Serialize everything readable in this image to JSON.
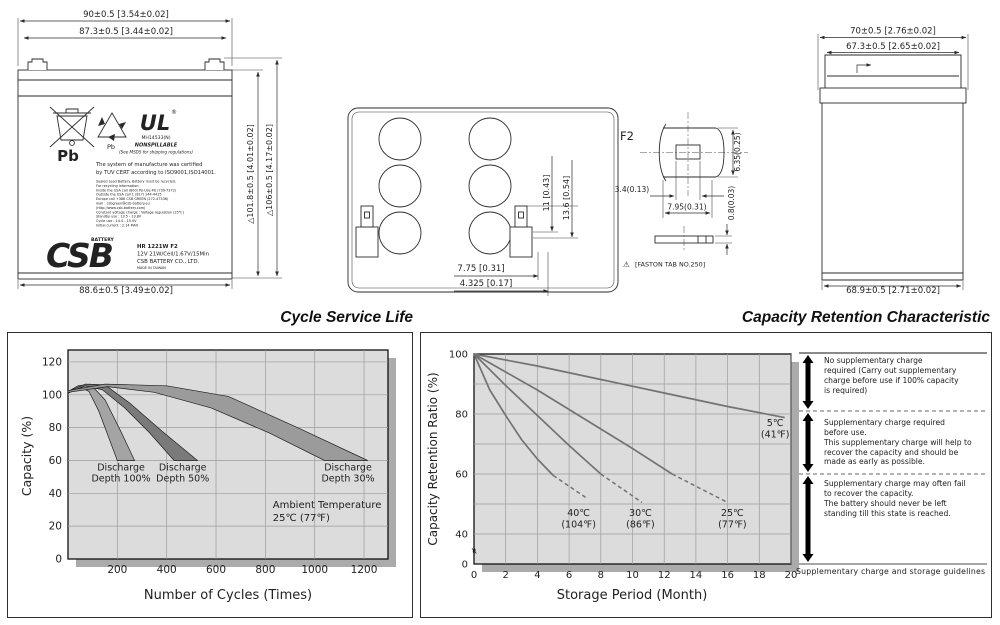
{
  "colors": {
    "plot_bg": "#dcdcdc",
    "plot_shadow": "#ababab",
    "grid": "#9c9c9c",
    "curve": "#737373",
    "band_100": "#a4a4a4",
    "band_50": "#7a7a7a",
    "band_30": "#9b9b9b"
  },
  "front_view": {
    "dims": {
      "top_outer": "90±0.5  [3.54±0.02]",
      "top_inner": "87.3±0.5  [3.44±0.02]",
      "bottom": "88.6±0.5  [3.49±0.02]",
      "height_case": "△101.8±0.5  [4.01±0.02]",
      "height_total": "△106±0.5  [4.17±0.02]"
    },
    "label": {
      "pb_large": "Pb",
      "pb_small": "Pb",
      "ul_mark": "UL",
      "ul_reg": "®",
      "ul_file": "MH14533(N)",
      "nonspillable": "NONSPILLABLE",
      "msds_note": "(See MSDS for shipping regulations)",
      "cert_line1": "The system of manufacture was certified",
      "cert_line2": "by TUV CERT according to ISO9001,ISO14001.",
      "small_print": [
        "Sealed Lead Battery. Battery must be recycled.",
        "For recycling information:",
        "Inside   the USA call (800) Po-Use-Pb (739-7372)",
        "Outside the USA call 1 (817) 244-4415",
        "Europe call   +386 CSB GREEN (272-47336)",
        "mail : csbgreen@csb-battery.eu",
        "(http://www.csb-battery.com)",
        "Constant voltage charge : Voltage regulation (25℃)",
        "Standby use    : 13.5 - 13.8V",
        "Cycle use       : 14.4 - 15.0V",
        "Initial current : 2.14 MAX"
      ],
      "brand": "CSB",
      "brand_sub": "BATTERY",
      "model": "HR 1221W F2",
      "spec": "12V 21W/Cell/1.67V/15Min",
      "company": "CSB BATTERY CO., LTD.",
      "origin": "MADE IN TAIWAN"
    }
  },
  "top_view": {
    "dims": {
      "tab_height": "11  [0.43]",
      "tab_height2": "13.6  [0.54]",
      "tab_offset": "7.75  [0.31]",
      "tab_offset2": "4.325  [0.17]"
    }
  },
  "terminal_detail": {
    "title": "F2",
    "dims": {
      "slot": "3.4(0.13)",
      "width": "7.95(0.31)",
      "height": "6.35(0.25)",
      "thickness": "0.8(0.03)"
    },
    "warning": "⚠",
    "note": "[FASTON  TAB  NO.250]"
  },
  "side_view": {
    "dims": {
      "top_outer": "70±0.5  [2.76±0.02]",
      "top_inner": "67.3±0.5  [2.65±0.02]",
      "bottom": "68.9±0.5  [2.71±0.02]"
    }
  },
  "chart_data": [
    {
      "type": "area",
      "title": "Cycle Service Life",
      "xlabel": "Number of Cycles (Times)",
      "ylabel": "Capacity (%)",
      "xlim": [
        0,
        1300
      ],
      "ylim": [
        0,
        127
      ],
      "xticks": [
        200,
        400,
        600,
        800,
        1000,
        1200
      ],
      "yticks": [
        0,
        20,
        40,
        60,
        80,
        100,
        120
      ],
      "grid": true,
      "legend_position": "none",
      "annotation_lines": [
        "Ambient Temperature",
        "25℃ (77℉)"
      ],
      "annotation_pos": [
        830,
        31
      ],
      "series": [
        {
          "name": "Discharge Depth 100%",
          "fill": "#a4a4a4",
          "label_lines": [
            "Discharge",
            "Depth 100%"
          ],
          "label_pos": [
            215,
            54
          ],
          "upper": [
            [
              0,
              102
            ],
            [
              40,
              105.5
            ],
            [
              90,
              106.5
            ],
            [
              150,
              97
            ],
            [
              210,
              79
            ],
            [
              270,
              60
            ]
          ],
          "lower": [
            [
              200,
              60
            ],
            [
              165,
              74
            ],
            [
              125,
              90
            ],
            [
              85,
              102
            ],
            [
              45,
              105
            ],
            [
              0,
              101
            ]
          ]
        },
        {
          "name": "Discharge Depth 50%",
          "fill": "#7a7a7a",
          "label_lines": [
            "Discharge",
            "Depth 50%"
          ],
          "label_pos": [
            465,
            54
          ],
          "upper": [
            [
              0,
              102
            ],
            [
              70,
              106.5
            ],
            [
              150,
              106
            ],
            [
              250,
              95
            ],
            [
              380,
              78
            ],
            [
              525,
              60
            ]
          ],
          "lower": [
            [
              430,
              60
            ],
            [
              330,
              77
            ],
            [
              230,
              92
            ],
            [
              140,
              103
            ],
            [
              70,
              105.5
            ],
            [
              0,
              101
            ]
          ]
        },
        {
          "name": "Discharge Depth 30%",
          "fill": "#9b9b9b",
          "label_lines": [
            "Discharge",
            "Depth 30%"
          ],
          "label_pos": [
            1135,
            54
          ],
          "upper": [
            [
              0,
              102.5
            ],
            [
              150,
              106.5
            ],
            [
              400,
              105.5
            ],
            [
              650,
              99
            ],
            [
              930,
              80
            ],
            [
              1215,
              60
            ]
          ],
          "lower": [
            [
              1040,
              60
            ],
            [
              820,
              76.5
            ],
            [
              580,
              92
            ],
            [
              350,
              101.5
            ],
            [
              160,
              105
            ],
            [
              0,
              101.5
            ]
          ]
        }
      ]
    },
    {
      "type": "line",
      "title": "Capacity Retention Characteristic",
      "xlabel": "Storage Period (Month)",
      "ylabel": "Capacity Retention Ratio (%)",
      "xlim": [
        0,
        20
      ],
      "ylim_display": [
        40,
        100
      ],
      "y_zero_label": "0",
      "y_break_glyph": "≈",
      "xticks": [
        0,
        2,
        4,
        6,
        8,
        10,
        12,
        14,
        16,
        18,
        20
      ],
      "yticks": [
        40,
        60,
        80,
        100
      ],
      "ygrid": [
        40,
        50,
        60,
        70,
        80,
        90
      ],
      "grid": true,
      "legend_position": "inline-labels",
      "series": [
        {
          "name": "5℃ (41℉)",
          "label_lines": [
            "5℃",
            "(41℉)"
          ],
          "label_pos": [
            19,
            76
          ],
          "solid": [
            [
              0,
              100
            ],
            [
              4,
              96
            ],
            [
              8,
              91.5
            ],
            [
              12,
              87
            ],
            [
              16,
              82.5
            ],
            [
              19.6,
              78.8
            ]
          ],
          "dashed": []
        },
        {
          "name": "25℃ (77℉)",
          "label_lines": [
            "25℃",
            "(77℉)"
          ],
          "label_pos": [
            16.3,
            46
          ],
          "solid": [
            [
              0,
              100
            ],
            [
              2,
              94
            ],
            [
              4,
              88
            ],
            [
              6,
              81.5
            ],
            [
              8,
              75
            ],
            [
              10,
              68.5
            ],
            [
              12.5,
              60
            ]
          ],
          "dashed": [
            [
              12.5,
              60
            ],
            [
              16,
              50.5
            ]
          ]
        },
        {
          "name": "30℃ (86℉)",
          "label_lines": [
            "30℃",
            "(86℉)"
          ],
          "label_pos": [
            10.5,
            46
          ],
          "solid": [
            [
              0,
              100
            ],
            [
              2,
              89.5
            ],
            [
              4,
              79.5
            ],
            [
              6,
              69.5
            ],
            [
              8,
              60
            ]
          ],
          "dashed": [
            [
              8,
              60
            ],
            [
              10.6,
              50.5
            ]
          ]
        },
        {
          "name": "40℃ (104℉)",
          "label_lines": [
            "40℃",
            "(104℉)"
          ],
          "label_pos": [
            6.6,
            46
          ],
          "solid": [
            [
              0,
              100
            ],
            [
              1,
              88
            ],
            [
              2,
              79.5
            ],
            [
              3,
              71.5
            ],
            [
              4,
              65
            ],
            [
              5,
              59.5
            ]
          ],
          "dashed": [
            [
              5,
              59.5
            ],
            [
              7.1,
              52
            ]
          ]
        }
      ]
    }
  ],
  "retention_notes": {
    "blocks": [
      {
        "text": "No supplementary charge\nrequired (Carry out supplementary\ncharge before use if 100% capacity\nis required)"
      },
      {
        "text": "Supplementary charge required\nbefore use.\nThis supplementary charge will help to\nrecover  the capacity and should be\nmade as early as possible."
      },
      {
        "text": "Supplementary charge may often fail\nto recover the capacity.\nThe battery should never be left\nstanding till this state is reached."
      }
    ],
    "caption": "Supplementary charge and storage guidelines"
  }
}
